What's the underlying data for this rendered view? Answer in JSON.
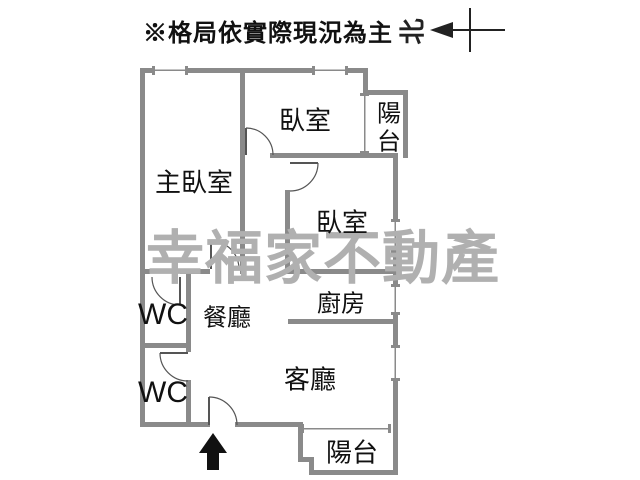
{
  "header": {
    "disclaimer": "※格局依實際現況為主",
    "compass_label": "北"
  },
  "watermark": {
    "text": "幸福家不動產",
    "color": "#b0b0b0"
  },
  "rooms": [
    {
      "name": "master-bedroom",
      "label": "主臥室"
    },
    {
      "name": "bedroom-top",
      "label": "臥室"
    },
    {
      "name": "balcony-top",
      "label": "陽台"
    },
    {
      "name": "bedroom-right",
      "label": "臥室"
    },
    {
      "name": "kitchen",
      "label": "廚房"
    },
    {
      "name": "dining-room",
      "label": "餐廳"
    },
    {
      "name": "wc-upper",
      "label": "WC"
    },
    {
      "name": "wc-lower",
      "label": "WC"
    },
    {
      "name": "living-room",
      "label": "客廳"
    },
    {
      "name": "balcony-bottom",
      "label": "陽台"
    }
  ],
  "colors": {
    "wall": "#8a8a8a",
    "door": "#555555",
    "text": "#111111",
    "arrow": "#111111"
  }
}
